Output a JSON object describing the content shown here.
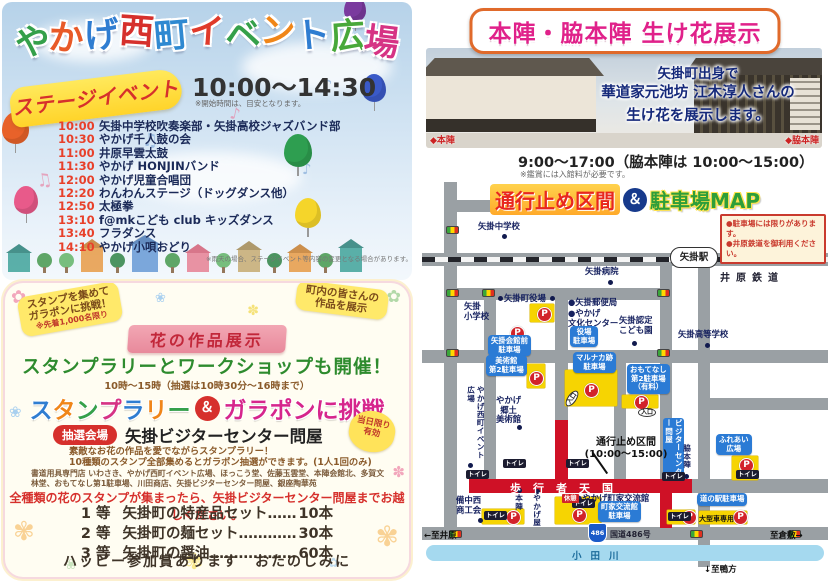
{
  "left": {
    "title": "やかげ西町イベント広場",
    "title_colors": [
      "#35a04a",
      "#e85a28",
      "#2f7dd1",
      "#d6302c",
      "#2f89d1",
      "#e03a2a",
      "#35a04a",
      "#f08619",
      "#2f7dd1",
      "#48a83a",
      "#d63384"
    ],
    "stage_banner": "ステージイベント",
    "time_range": "10:00〜14:30",
    "time_note": "※開始時間は、目安となります。",
    "schedule": [
      {
        "time": "10:00",
        "act": "矢掛中学校吹奏楽部・矢掛高校ジャズバンド部"
      },
      {
        "time": "10:30",
        "act": "やかげ千人鼓の会"
      },
      {
        "time": "11:00",
        "act": "井原早雲太鼓"
      },
      {
        "time": "11:30",
        "act": "やかげ HONJINバンド"
      },
      {
        "time": "12:00",
        "act": "やかげ児童合唱団"
      },
      {
        "time": "12:20",
        "act": "わんわんステージ（ドッグダンス他）"
      },
      {
        "time": "12:50",
        "act": "太極拳"
      },
      {
        "time": "13:10",
        "act": "f@mkこども club キッズダンス"
      },
      {
        "time": "13:40",
        "act": "フラダンス"
      },
      {
        "time": "14:10",
        "act": "やかげ小唄おどり"
      }
    ],
    "schedule_note": "※雨天の場合、ステージイベント等内容の変更となる場合があります。",
    "stamp": {
      "badge_collect_1": "スタンプを集めて",
      "badge_collect_2": "ガラポンに挑戦！",
      "badge_collect_note": "※先着1,000名限り",
      "badge_town_1": "町内の皆さんの",
      "badge_town_2": "作品を展示",
      "flower_ribbon": "花の作品展示",
      "headline": "スタンプラリーとワークショップも開催！",
      "hours": "10時〜15時（抽選は10時30分〜16時まで）",
      "challenge_stamp": "スタンプラリー",
      "challenge_stamp_colors": [
        "#2f7dd1",
        "#f08619",
        "#35a04a",
        "#d63384",
        "#2f7dd1",
        "#f08619",
        "#35a04a"
      ],
      "challenge_amp": "＆",
      "challenge_garapon": "ガラポンに挑戦",
      "venue_tag": "抽選会場",
      "venue_name": "矢掛ビジターセンター問屋",
      "valid_1": "当日限り",
      "valid_2": "有効",
      "desc_1": "素敵なお花の作品を愛でながらスタンプラリー！",
      "desc_2": "10種類のスタンプ全部集めるとガラポン抽選ができます。(1人1回のみ)",
      "stamp_locations": "書道用具専門店 いわさき、やかげ西町イベント広場、ほっこう堂、佐藤玉雲堂、本陣会館北、多賀文林堂、おもてなし第1駐車場、川田商店、矢掛ビジターセンター問屋、銀座陶華苑",
      "cta": "全種類の花のスタンプが集まったら、矢掛ビジターセンター問屋までお越しください。",
      "prizes": [
        {
          "rank": "1 等",
          "name": "矢掛町の特産品セット",
          "dots": "……",
          "count": "10本"
        },
        {
          "rank": "2 等",
          "name": "矢掛町の麺セット",
          "dots": "…………",
          "count": "30本"
        },
        {
          "rank": "3 等",
          "name": "矢掛町の醤油",
          "dots": "………………",
          "count": "60本"
        }
      ],
      "footer": "ハッピー参加賞あります　おたのしみに"
    }
  },
  "right": {
    "title": "本陣・脇本陣 生け花展示",
    "caption_1": "矢掛町出身で",
    "caption_2": "華道家元池坊 江木淳人さんの",
    "caption_3": "生け花を展示します。",
    "label_honjin": "◆本陣",
    "label_wakihonjin": "◆脇本陣",
    "hours": "9:00〜17:00（脇本陣は 10:00〜15:00）",
    "hours_note": "※鑑賞には入館料が必要です。",
    "map": {
      "title_closure": "通行止め区間",
      "title_amp": "＆",
      "title_parking": "駐車場MAP",
      "notice_1": "●駐車場には限りがあります。",
      "notice_2": "●井原鉄道を御利用ください。",
      "station": "矢掛駅",
      "railway": "井原鉄道",
      "closure_note": "通行止め区間\n(10:00〜15:00)",
      "pedestrian": "歩行者天国",
      "route_badge": "486",
      "route_name": "国道486号",
      "river": "小田川",
      "dir_west": "←至井原",
      "dir_east": "至倉敷→",
      "dir_south": "↓至鴨方",
      "toilet": "トイレ",
      "entrance": "入口",
      "rest_tag": "休憩",
      "large_vehicle": "大型車専用",
      "p": "P",
      "pois": [
        {
          "text": "矢掛中学校"
        },
        {
          "text": "矢掛病院"
        },
        {
          "text": "矢掛町役場"
        },
        {
          "text": "矢掛\n小学校"
        },
        {
          "text": "●矢掛郵便局"
        },
        {
          "text": "●やかげ\n文化センター"
        },
        {
          "text": "矢掛認定\nこども園"
        },
        {
          "text": "矢掛高等学校"
        },
        {
          "text": "やかげ\n郷土\n美術館"
        },
        {
          "text": "備中西\n商工会"
        },
        {
          "text": "本陣"
        },
        {
          "text": "やかげ屋"
        },
        {
          "text": "●やかげ町家交流館"
        },
        {
          "text": "やかげ西町イベント広場"
        },
        {
          "text": "ビジターセンター問屋"
        },
        {
          "text": "脇本陣"
        }
      ],
      "parkings": [
        {
          "text": "役場\n駐車場"
        },
        {
          "text": "矢掛会館前\n駐車場"
        },
        {
          "text": "美術館\n第2駐車場"
        },
        {
          "text": "マルナカ跡\n駐車場"
        },
        {
          "text": "おもてなし\n第2駐車場\n（有料）"
        },
        {
          "text": "町家交流館\n駐車場"
        },
        {
          "text": "道の駅駐車場"
        },
        {
          "text": "ふれあい\n広場"
        }
      ]
    }
  }
}
